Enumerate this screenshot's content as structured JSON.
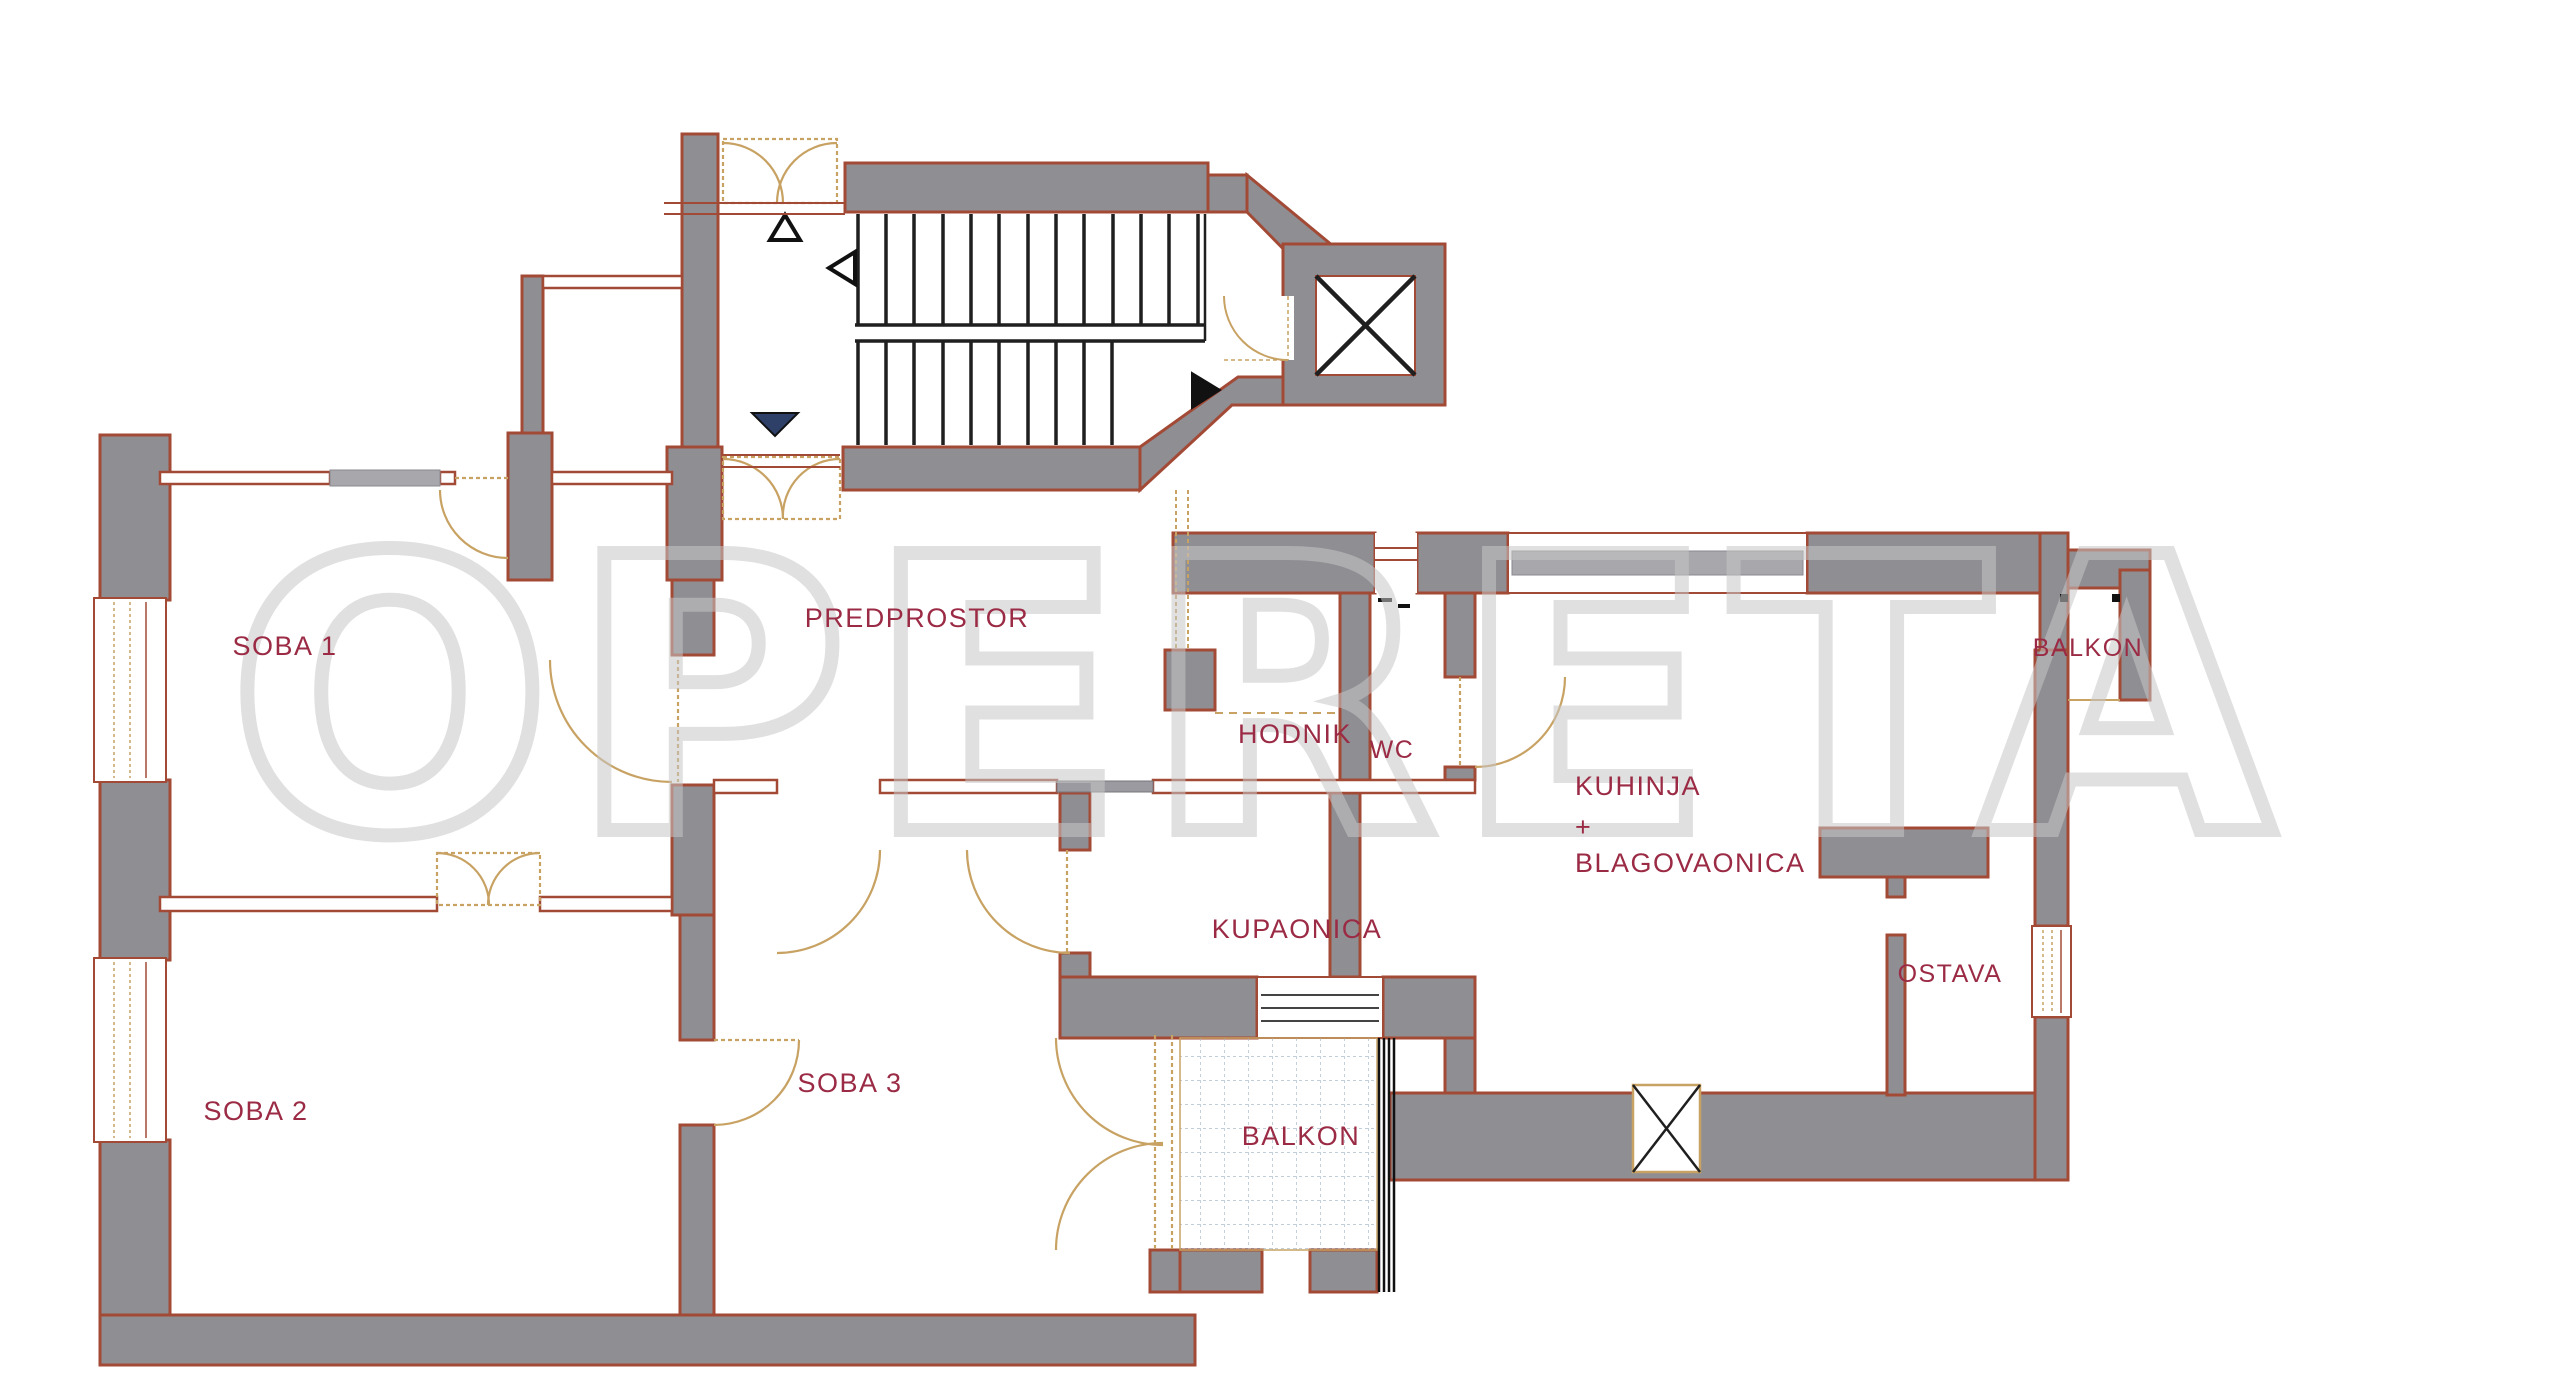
{
  "plan": {
    "watermark": "OPERETA",
    "colors": {
      "wall_fill": "#8f8e93",
      "wall_outline": "#a34a36",
      "door_swing": "#c8a263",
      "stairs": "#1f1f1f",
      "label": "#9b2b45",
      "watermark": "#c7c7c7",
      "glass": "#a7a7ac",
      "balcony_tile": "#9bb0c4",
      "arrow_down_fill": "#2e3f68"
    },
    "rooms": [
      {
        "id": "soba1",
        "label": "SOBA 1"
      },
      {
        "id": "soba2",
        "label": "SOBA 2"
      },
      {
        "id": "soba3",
        "label": "SOBA 3"
      },
      {
        "id": "predprostor",
        "label": "PREDPROSTOR"
      },
      {
        "id": "hodnik",
        "label": "HODNIK"
      },
      {
        "id": "kupaonica",
        "label": "KUPAONICA"
      },
      {
        "id": "wc",
        "label": "WC"
      },
      {
        "id": "kuhinja_line1",
        "label": "KUHINJA"
      },
      {
        "id": "kuhinja_line2",
        "label": "+"
      },
      {
        "id": "kuhinja_line3",
        "label": "BLAGOVAONICA"
      },
      {
        "id": "ostava",
        "label": "OSTAVA"
      },
      {
        "id": "balkon_top",
        "label": "BALKON"
      },
      {
        "id": "balkon_bottom",
        "label": "BALKON"
      }
    ]
  }
}
